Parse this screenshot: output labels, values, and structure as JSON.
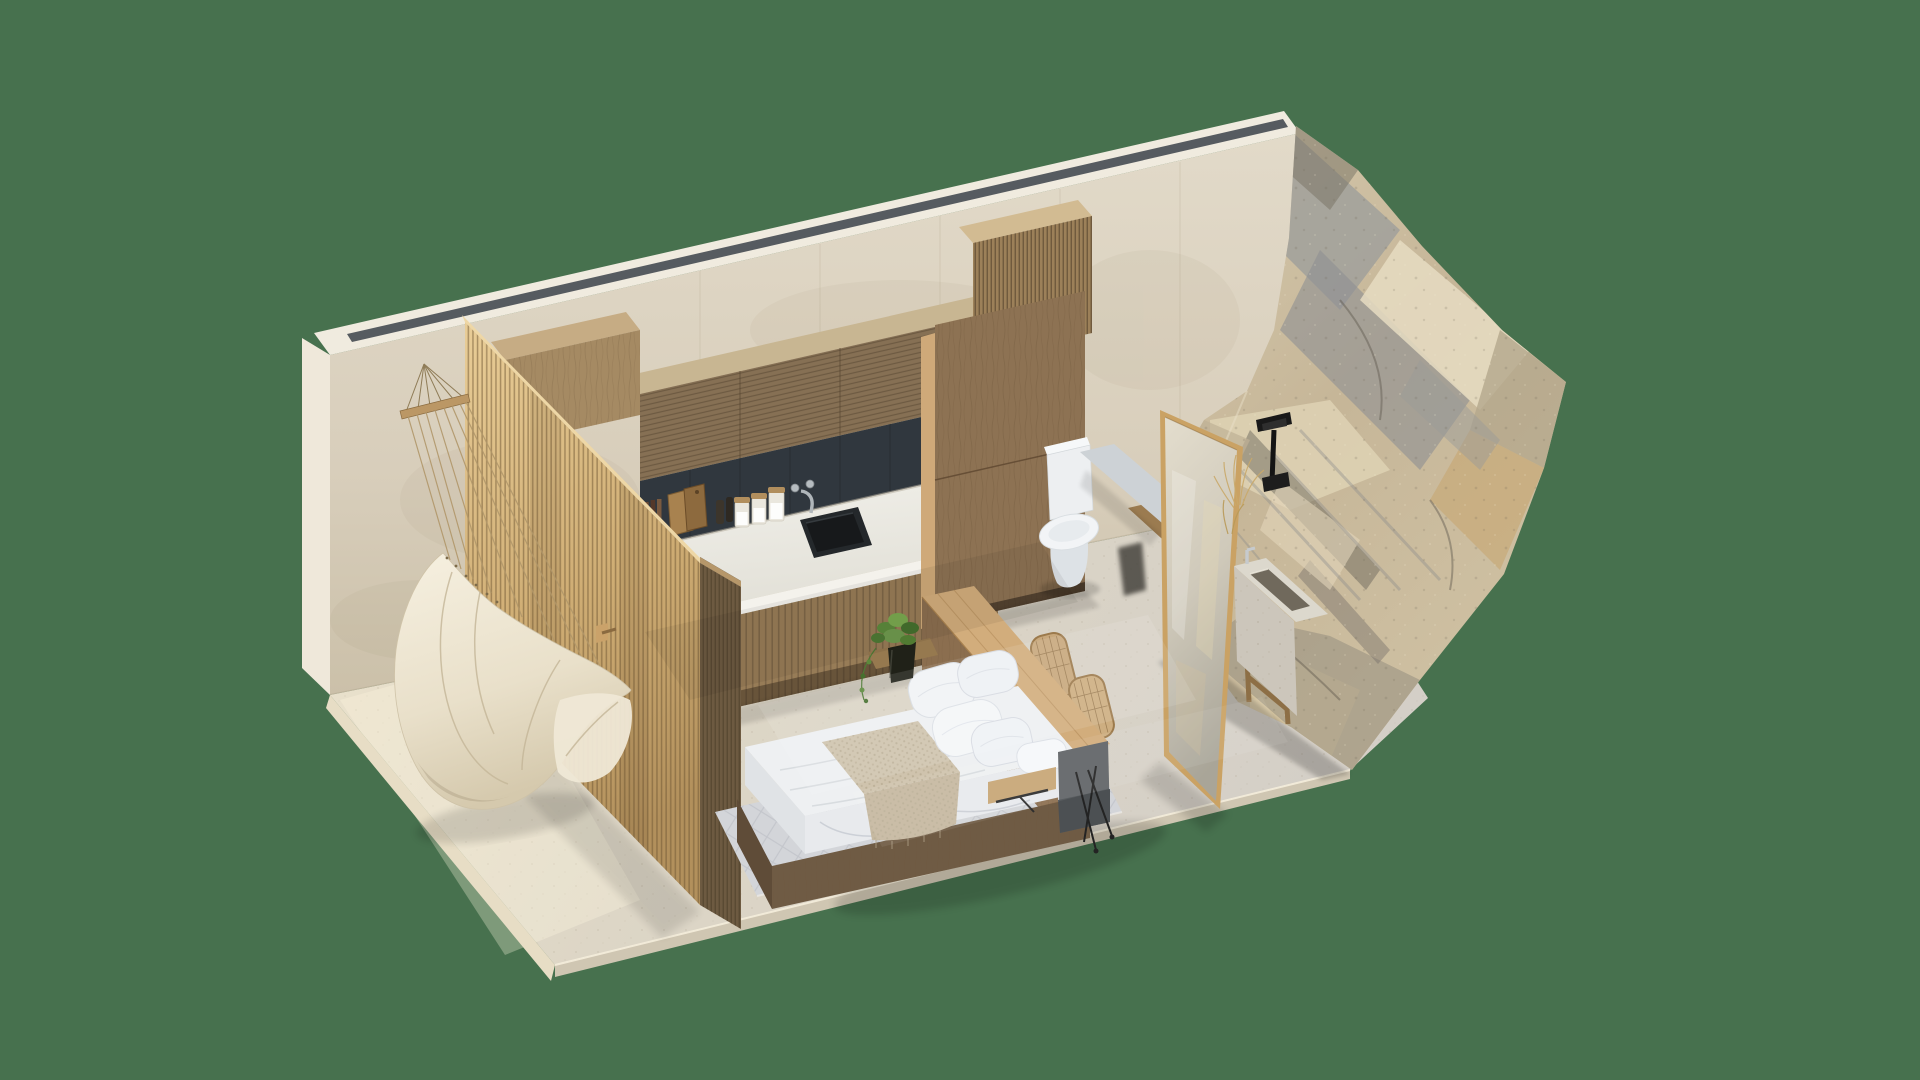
{
  "scene": {
    "type": "architectural-3d-isometric-cutaway-render",
    "title": "Isometric cutaway render of a compact studio suite with kitchenette, platform bed, hanging hammock chair and a natural boulder bathroom wall",
    "background_color": "#47714e",
    "visible_text": [],
    "palette": {
      "background": "#47714e",
      "travertine_wall": "#ddd4c3",
      "wall_top_cap": "#f0ebdf",
      "light_slot": "#565b60",
      "floor_warm": "#e9e1cc",
      "floor_cool": "#d5d0c8",
      "slat_screen_light": "#d9b87e",
      "slat_screen_dark": "#74604536",
      "cabinet_wood": "#8d7253",
      "countertop": "#eceae4",
      "backsplash": "#30373e",
      "sink_black": "#24282b",
      "bedding_white": "#f2f4f6",
      "throw_beige": "#cfc3ad",
      "rug_grey": "#d3d5d9",
      "desk_wood": "#d2ad7c",
      "rattan": "#c8a87c",
      "concrete": "#cdd2d6",
      "rock_tan": "#cbbb9d",
      "rock_grey": "#95958f",
      "fixture_black": "#191919",
      "plant_green": "#6f9a4e"
    },
    "areas": [
      {
        "name": "shower-hammock-nook",
        "objects": [
          "travertine back wall",
          "recessed ceiling light slot",
          "wall-mounted wooden suspension bar",
          "rope-hung hammock chair",
          "timber slat partition screen",
          "towel hook"
        ]
      },
      {
        "name": "kitchenette",
        "objects": [
          "fluted timber upper cabinets",
          "charcoal tile backsplash",
          "white stone countertop",
          "black undermount sink",
          "wall-mounted chrome faucet",
          "glass storage jars x3",
          "wooden cutting boards x2",
          "pepper grinders x2",
          "fluted base cabinets",
          "tall timber pantry column"
        ]
      },
      {
        "name": "sleeping-area",
        "objects": [
          "platform bed",
          "white duvet and sheets",
          "knit throw blanket",
          "white pillows x5",
          "timber headboard desk",
          "floating side shelf",
          "grey steel desk end panel",
          "rattan chairs x2",
          "potted trailing plant",
          "woven area rug"
        ]
      },
      {
        "name": "bathroom",
        "objects": [
          "white toilet",
          "floating concrete bench",
          "timber shelf board",
          "freestanding framed mirror panel",
          "natural boulder rock wall",
          "black wall-mounted tap",
          "carved stone trough basin",
          "dried grass sprigs"
        ]
      }
    ]
  }
}
